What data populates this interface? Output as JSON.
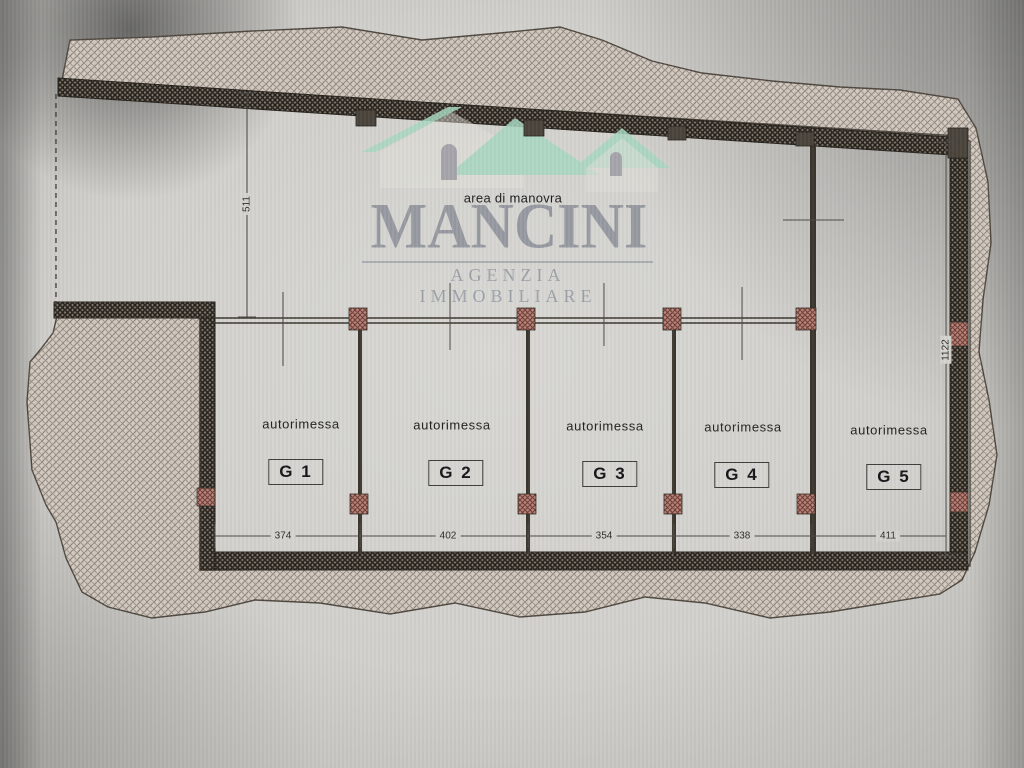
{
  "watermark": {
    "brand": "MANCINI",
    "subtitle": "AGENZIA IMMOBILIARE"
  },
  "plan": {
    "area_label": "area di manovra",
    "dim_left_depth": "511",
    "dim_right_depth": "1122",
    "garages": [
      {
        "type_label": "autorimessa",
        "code": "G 1",
        "width": "374"
      },
      {
        "type_label": "autorimessa",
        "code": "G 2",
        "width": "402"
      },
      {
        "type_label": "autorimessa",
        "code": "G 3",
        "width": "354"
      },
      {
        "type_label": "autorimessa",
        "code": "G 4",
        "width": "338"
      },
      {
        "type_label": "autorimessa",
        "code": "G 5",
        "width": "411"
      }
    ]
  },
  "colors": {
    "paper": "#d4d3cf",
    "terrain_hatch": "#8f857b",
    "wall_dark": "#3b362e",
    "pilaster_red": "#a96f63",
    "roof_green": "#a8d8c1",
    "logo_gray": "#8a8e97"
  }
}
